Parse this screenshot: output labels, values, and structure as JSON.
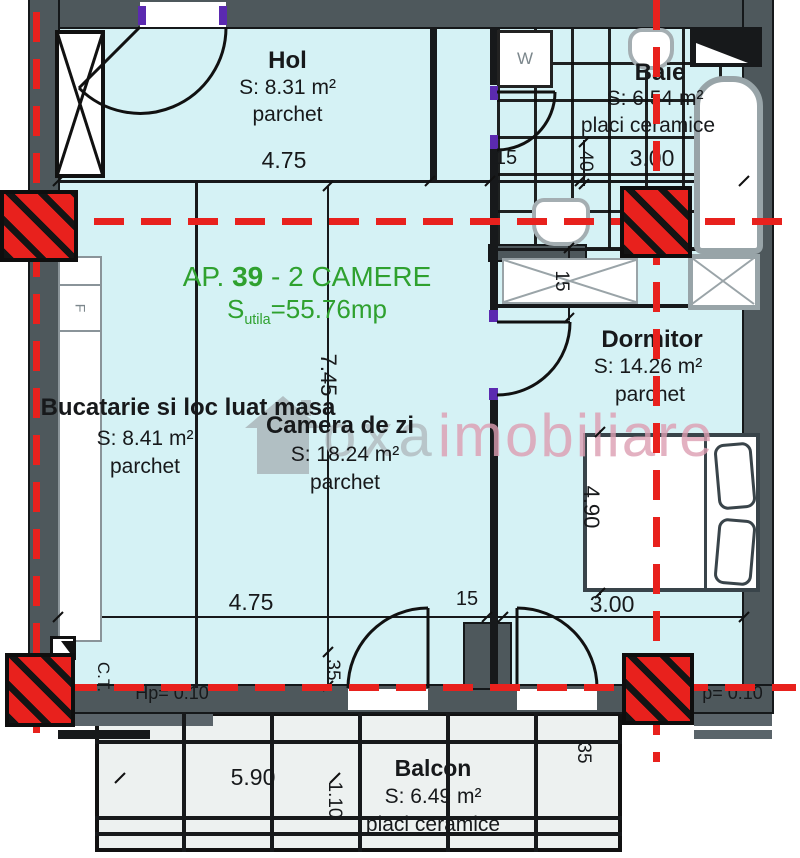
{
  "colors": {
    "wall": "#4e585c",
    "room": "#d5f2f5",
    "balcony": "#edf1f0",
    "red": "#e8211d",
    "green": "#2fa12f",
    "wm_gray": "#b2bbbf",
    "wm_pink": "#dd9eb2",
    "purple": "#5b2ab0",
    "line": "#17191b"
  },
  "header": {
    "ap_prefix": "AP. ",
    "ap_number": "39",
    "ap_suffix": " - 2 CAMERE",
    "s_label": "S",
    "s_sub": "utila",
    "s_value": "=55.76mp"
  },
  "rooms": {
    "hol": {
      "name": "Hol",
      "area": "S: 8.31 m²",
      "floor": "parchet"
    },
    "baie": {
      "name": "Baie",
      "area": "S: 6.54 m²",
      "floor": "placi ceramice"
    },
    "bucatarie": {
      "name": "Bucatarie si loc luat masa",
      "area": "S: 8.41 m²",
      "floor": "parchet"
    },
    "camera_de_zi": {
      "name": "Camera de zi",
      "area": "S: 18.24 m²",
      "floor": "parchet"
    },
    "dormitor": {
      "name": "Dormitor",
      "area": "S: 14.26 m²",
      "floor": "parchet"
    },
    "balcon": {
      "name": "Balcon",
      "area": "S: 6.49 m²",
      "floor": "placi ceramice"
    }
  },
  "dimensions": {
    "hol_width": "4.75",
    "top_wall": "15",
    "baie_depth": "40",
    "baie_width": "3.00",
    "living_height": "7.45",
    "hall_wall": "15",
    "dormitor_height": "4.90",
    "living_width": "4.75",
    "bottom_wall": "15",
    "dormitor_width": "3.00",
    "wall_left": "35",
    "parapet_left": "Hp= 0.10",
    "parapet_right": "p= 0.10",
    "balcon_width": "5.90",
    "balcon_depth": "1.10",
    "wall_right": "35"
  },
  "labels": {
    "boiler": "C.T.",
    "washer": "W",
    "fridge": "F"
  },
  "watermark": {
    "gray": "oxa",
    "pink": "imobiliare"
  }
}
